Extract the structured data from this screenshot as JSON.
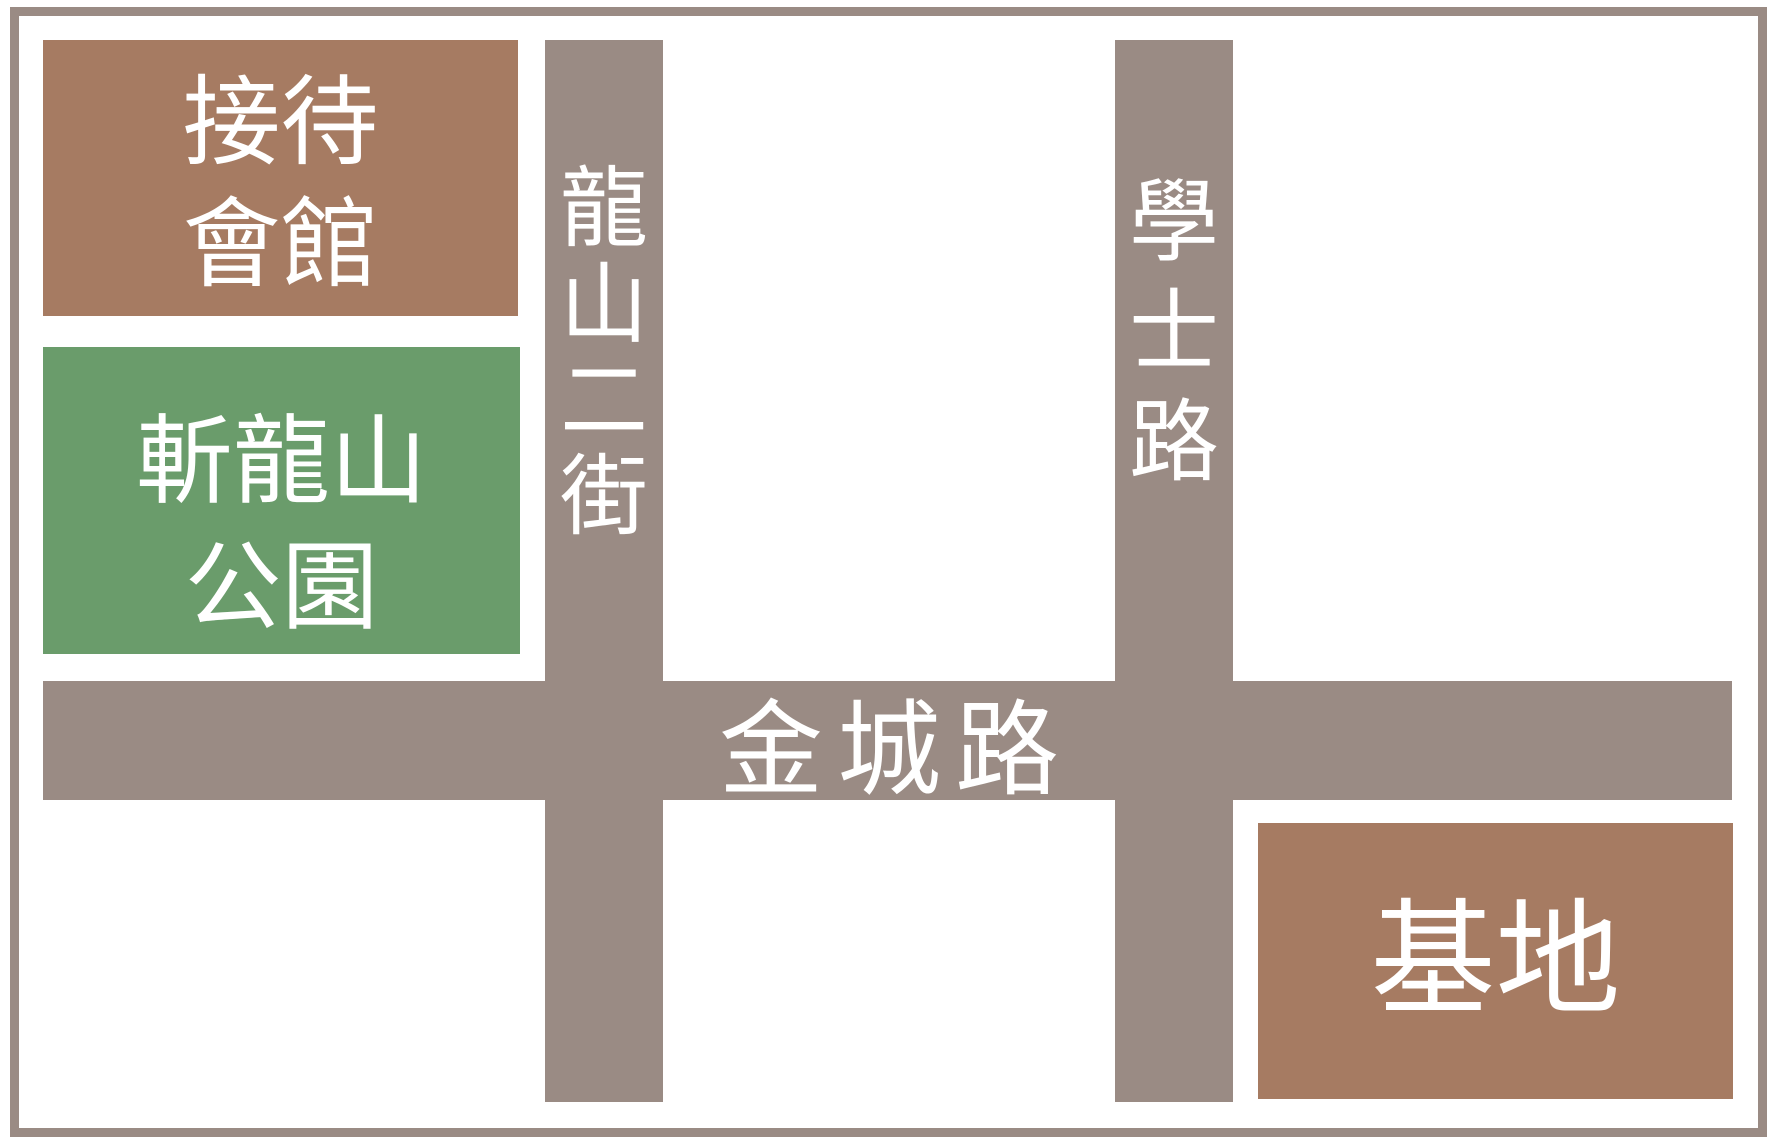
{
  "map": {
    "colors": {
      "road": "#9a8b84",
      "border": "#9a8b84",
      "building_brown": "#a67b62",
      "park_green": "#6a9c6b",
      "label_text": "#ffffff",
      "background": "#ffffff"
    },
    "buildings": {
      "reception": {
        "line1": "接待",
        "line2": "會館"
      },
      "park": {
        "line1": "斬龍山",
        "line2": "公園"
      },
      "site": {
        "label": "基地"
      }
    },
    "roads": {
      "longshan_2nd_street": "龍山二街",
      "xueshi_road": "學士路",
      "jincheng_road": "金城路"
    }
  }
}
